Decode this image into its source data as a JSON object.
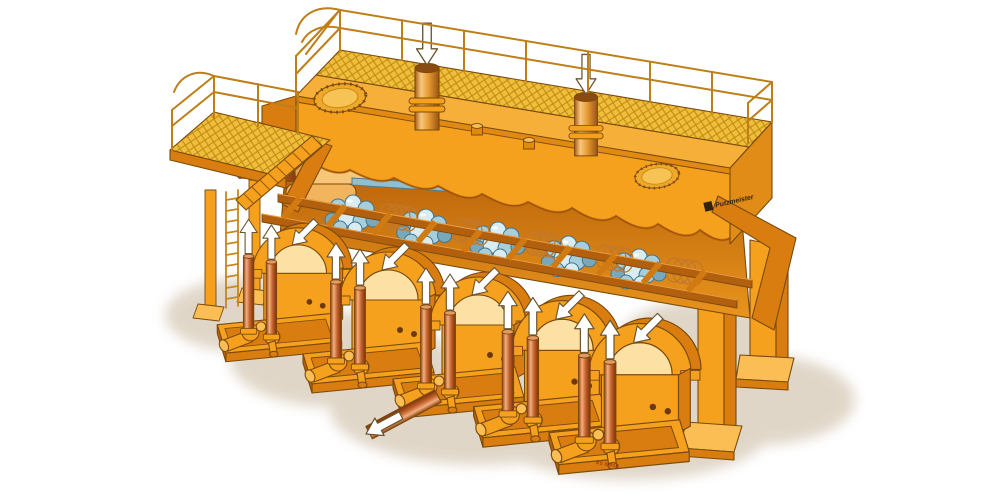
{
  "illustration": {
    "description": "Isometric cutaway illustration of an industrial five-unit piston pump station in orange livery, with top walkway, railings, inlet pipes and flow arrows",
    "background_color": "#FFFFFF"
  },
  "labels": {
    "brand_logo": "Putzmeister",
    "drawing_number": "KS 0981B"
  },
  "palette": {
    "body_orange": "#F5A11E",
    "body_orange_light": "#FBBE55",
    "body_orange_dark": "#DA7D10",
    "body_orange_deep": "#C06008",
    "cream_highlight": "#FCE0A4",
    "outline_brown": "#7A4A0C",
    "mesh_yellow": "#EFBE3C",
    "mesh_line": "#C08A10",
    "railing_orange": "#BE7E18",
    "media_ball_blue": "#A6CEDC",
    "media_ball_blue_dark": "#79A8BA",
    "pipe_copper": "#C2602A",
    "pipe_copper_highlight": "#F2AF7E",
    "flow_arrow_white": "#FFFFFF",
    "ground_shadow": "#D9CDBB"
  },
  "components": {
    "inlet_pipes": 2,
    "inlet_arrow_direction": "down",
    "manhole_covers": 2,
    "vent_caps": 2,
    "pump_units": 5,
    "riser_pipes_per_unit": 2,
    "riser_arrow_direction": "up",
    "pump_arch_arrow_direction": "down-left",
    "discharge_pipes": 1,
    "media_ball_clusters": 5,
    "coil_springs": 5,
    "support_legs": 4,
    "ladders": 1,
    "walkway_platforms": 2,
    "guard_railings": 2
  }
}
